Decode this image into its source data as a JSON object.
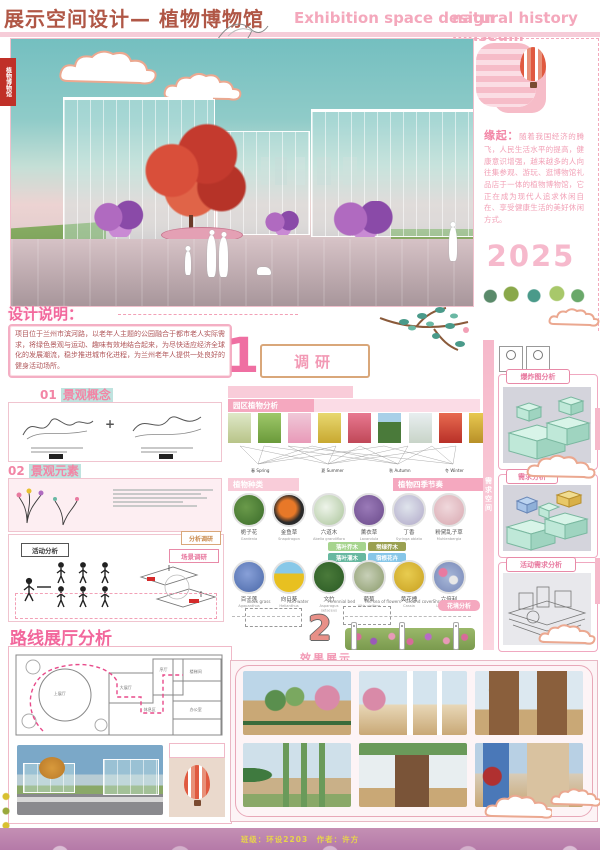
{
  "header": {
    "title_cn": "展示空间设计— 植物博物馆",
    "title_en_1": "Exhibition space design",
    "title_en_2": "natural history museum"
  },
  "stamp": "植物博物馆",
  "origin": {
    "label": "缘起：",
    "text": "随着我国经济的腾飞，人民生活水平的提高，健康意识增强，越来越多的人向往集参观、游玩、逛博物馆礼品店于一体的植物博物馆，它正在成为现代人追求休闲自在、享受健康生活的美好休闲方式。",
    "year": "2025"
  },
  "design_note": {
    "heading": "设计说明：",
    "body": "项目位于兰州市滨河路，以老年人主题的公园融合于都市老人实际需求，将绿色景观与运动、趣味有效地结合起来，为尽快适应经济全球化的发展潮流，稳步推进城市化进程，为兰州老年人提供一处良好的健身活动场所。"
  },
  "section1": {
    "number": "1",
    "label": "调研"
  },
  "section2": {
    "number": "2",
    "label": "效果展示",
    "garden_tag": "花境分析",
    "micro_labels": [
      "Block grass",
      "Acid water",
      "Perennial bed",
      "The sea of flowers",
      "Ground cover",
      "Shrub"
    ]
  },
  "left": {
    "s01_num": "01",
    "s01_title": "景观概念",
    "plus": "+",
    "s02_num": "02",
    "s02_title": "景观元素",
    "corner_tag": "分析调研",
    "activity_tag": "活动分析",
    "scene_tag": "场景调研",
    "route_heading": "路线展厅分析",
    "plan_rooms": [
      "上展厅",
      "大展厅",
      "序厅",
      "休息区",
      "楼梯间",
      "办公室"
    ]
  },
  "plants": {
    "bar_analysis": "园区植物分析",
    "bar_species": "植物种类",
    "bar_season": "植物四季节奏",
    "seasons": [
      {
        "cn": "春",
        "en": "Spring"
      },
      {
        "cn": "夏",
        "en": "Summer"
      },
      {
        "cn": "秋",
        "en": "Autumn"
      },
      {
        "cn": "冬",
        "en": "Winter"
      }
    ],
    "legend": [
      {
        "label": "落叶乔木",
        "color": "#a6d48e"
      },
      {
        "label": "常绿乔木",
        "color": "#9aa050"
      },
      {
        "label": "落叶灌木",
        "color": "#67b8a0"
      },
      {
        "label": "宿根花卉",
        "color": "#86c6e8"
      }
    ],
    "row1": [
      {
        "name": "栀子花",
        "latin": "Gardenia"
      },
      {
        "name": "金鱼草",
        "latin": "Snapdragon"
      },
      {
        "name": "六道木",
        "latin": "Abelia grandiflora"
      },
      {
        "name": "薰衣草",
        "latin": "Lavandula"
      },
      {
        "name": "丁香",
        "latin": "Syringa oblata"
      },
      {
        "name": "粉黛乱子草",
        "latin": "Muhlenbergia"
      }
    ],
    "row2": [
      {
        "name": "百子莲",
        "latin": "Agapanthus"
      },
      {
        "name": "向日葵",
        "latin": "Helianthus"
      },
      {
        "name": "文竹",
        "latin": "Asparagus setaceus"
      },
      {
        "name": "葡萄",
        "latin": "Vitis vinifera"
      },
      {
        "name": "黄花槐",
        "latin": "Cassia"
      },
      {
        "name": "六倍利",
        "latin": "Lobelia erinus"
      }
    ]
  },
  "right": {
    "vertical_tag": "需求空间",
    "pill1": "爆炸图分析",
    "pill2": "需求分析",
    "pill3": "活动需求分析"
  },
  "footer": {
    "credit": "班级：环设2203　作者：许方"
  },
  "colors": {
    "accent_pink": "#f2679c",
    "light_pink": "#f9ccd9",
    "title_brown": "#b05746",
    "teal_sky": "#7fc4c4",
    "mint_block": "#bfe8d8",
    "footer_purple": "#b57aa8",
    "seal_red": "#c03028",
    "year_pink": "#f6b9cc"
  }
}
